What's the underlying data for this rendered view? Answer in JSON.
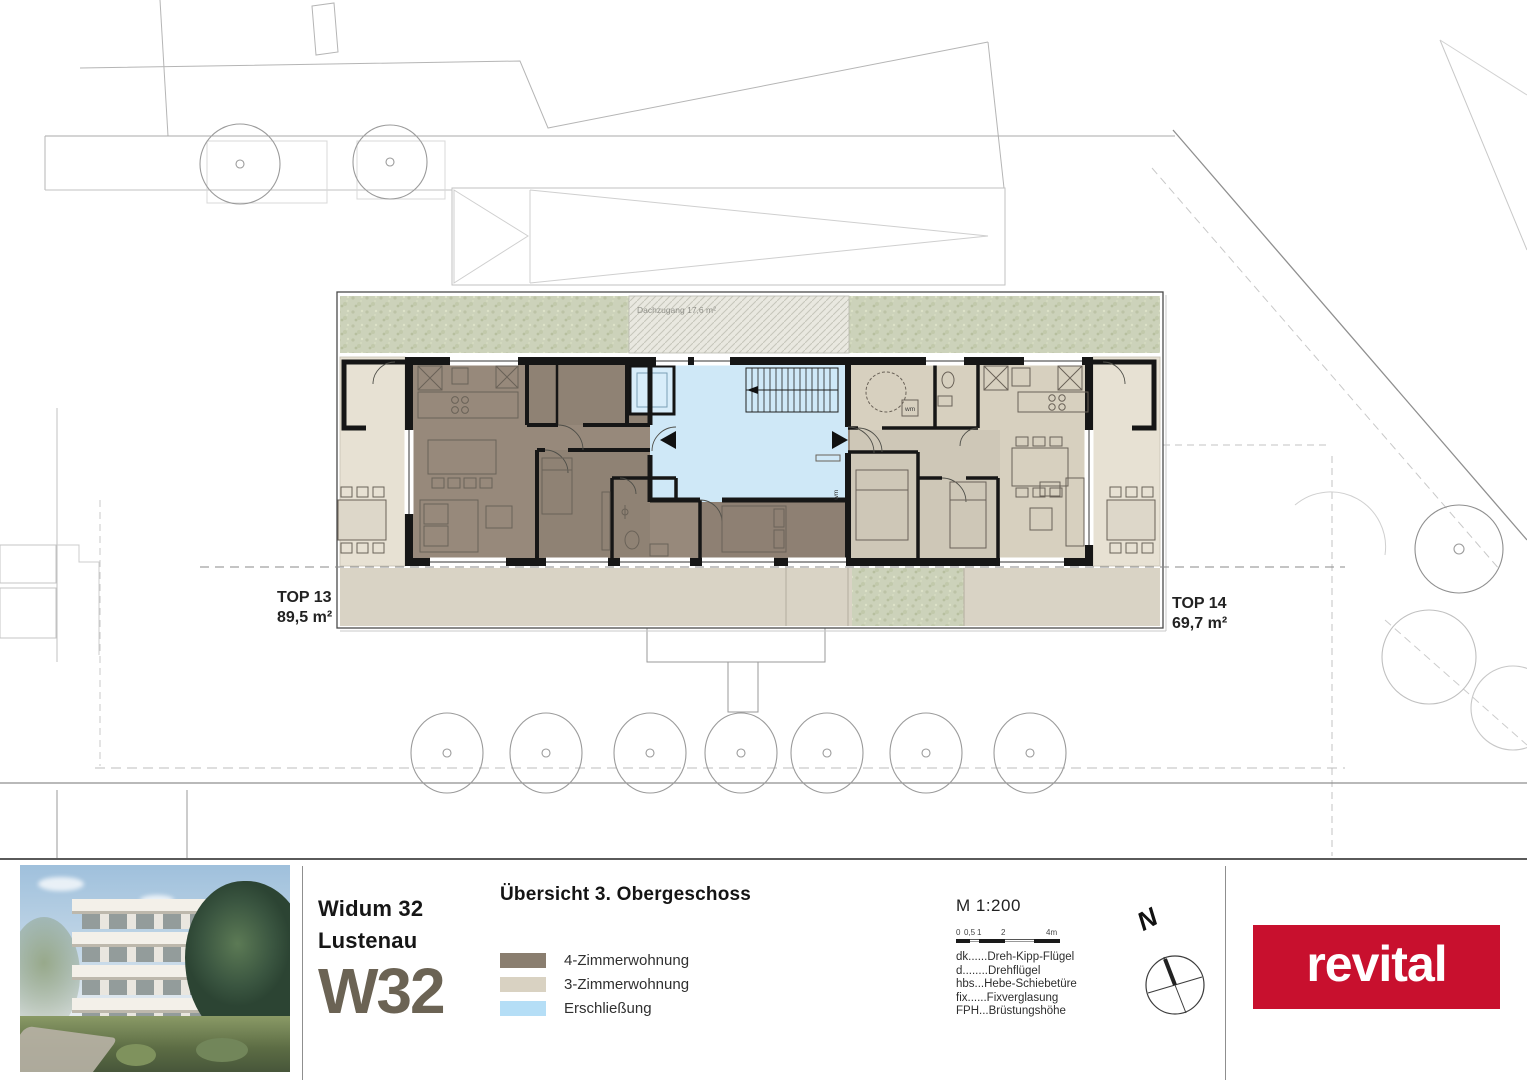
{
  "plan": {
    "top13": {
      "label": "TOP 13",
      "area": "89,5 m²"
    },
    "top14": {
      "label": "TOP 14",
      "area": "69,7 m²"
    },
    "roof_access_label": "Dachzugang 17,6 m²",
    "wm_label": "wm",
    "colors": {
      "four_room_fill": "#97897b",
      "three_room_fill": "#d7d0bf",
      "circulation_fill": "#cfe8f7",
      "outdoor_fill": "#e7e1d3",
      "grass_fill": "#ccd2ba",
      "wall": "#161616"
    }
  },
  "footer": {
    "project": {
      "name": "Widum 32",
      "city": "Lustenau",
      "code": "W32"
    },
    "sheet_title": "Übersicht 3. Obergeschoss",
    "legend": [
      {
        "label": "4-Zimmerwohnung",
        "color": "#8a7e6f"
      },
      {
        "label": "3-Zimmerwohnung",
        "color": "#d9d2c2"
      },
      {
        "label": "Erschließung",
        "color": "#b5def6"
      }
    ],
    "scale": {
      "label": "M 1:200",
      "ticks": [
        "0",
        "0,5",
        "1",
        "2",
        "4m"
      ]
    },
    "abbreviations": [
      "dk......Dreh-Kipp-Flügel",
      "d........Drehflügel",
      "hbs...Hebe-Schiebetüre",
      "fix......Fixverglasung",
      "FPH...Brüstungshöhe"
    ],
    "north_label": "N",
    "logo_text": "revital",
    "logo_color": "#c8102e"
  }
}
